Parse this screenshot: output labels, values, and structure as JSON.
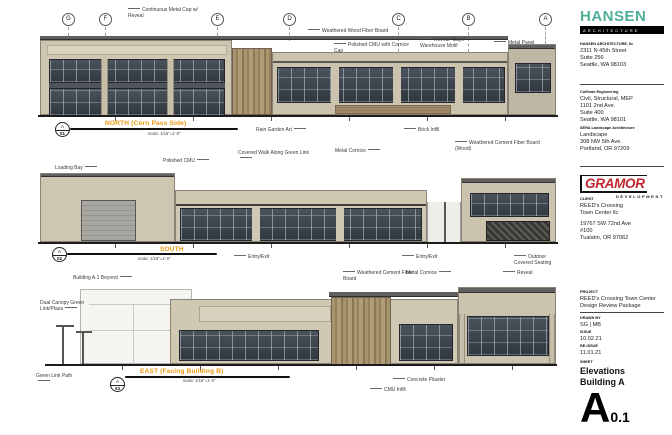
{
  "accents": {
    "elevation_title": "#e8950c",
    "architect_teal": "#4fb09a",
    "developer_red": "#c0272d"
  },
  "grid": {
    "labels": [
      "G",
      "F",
      "E",
      "D",
      "C",
      "B",
      "A"
    ]
  },
  "elevations": {
    "north": {
      "title": "NORTH (Corn Pass Side)",
      "scale": "scale: 1/16\"=1'-0\"",
      "marker": {
        "top": "A",
        "bottom": "01"
      },
      "callouts": {
        "metal_cap": "Continuous Metal Cap w/ Reveal",
        "wood_fiber": "Weathered Wood Fiber Board",
        "polished_cmu": "Polished CMU with Cornice Cap",
        "reveal_bays": "Reveal \"Bays\" Warehouse Motif",
        "metal_panel": "Metal Panel",
        "rain_garden": "Rain Garden Art",
        "brick_infill": "Brick Infill"
      }
    },
    "south": {
      "title": "SOUTH",
      "scale": "scale: 1/16\"=1'-0\"",
      "marker": {
        "top": "A",
        "bottom": "02"
      },
      "callouts": {
        "loading_bay": "Loading Bay",
        "polished_cmu": "Polished CMU",
        "covered_walk": "Covered Walk Along Green Link",
        "metal_cornice": "Metal Cornice",
        "cement_fiber": "Weathered Cement Fiber Board (Wood)",
        "entry_exit_1": "Entry/Exit",
        "entry_exit_2": "Entry/Exit",
        "outdoor_seating": "Outdoor Covered Seating"
      }
    },
    "east": {
      "title": "EAST (Facing Building B)",
      "scale": "scale: 1/16\"=1'-0\"",
      "marker": {
        "top": "A",
        "bottom": "03"
      },
      "callouts": {
        "building_beyond": "Building A.1 Beyond",
        "dual_canopy": "Dual Canopy Green Link/Plaza",
        "cement_fiber": "Weathered Cement Fiber Board",
        "metal_cornice": "Metal Cornice",
        "reveal": "Reveal",
        "green_link": "Green Link Path",
        "cmu_infill": "CMU Infill",
        "concrete_pilaster": "Concrete Pilaster"
      }
    }
  },
  "titleblock": {
    "architect": {
      "logo_text": "HANSEN",
      "logo_sub": "ARCHITECTURE",
      "firm_heading": "HANSEN ARCHITECTURE, llc",
      "firm_lines": [
        "2311 N 45th Street",
        "Suite 256",
        "Seattle, WA 98103"
      ]
    },
    "consultants": [
      {
        "heading": "Coffman Engineering",
        "lines": [
          "Civil, Structural, MEP",
          "1101 2nd Ave.",
          "Suite 400",
          "Seattle, WA 98101"
        ]
      },
      {
        "heading": "SERA Landscape Architecture",
        "lines": [
          "Landscape",
          "308 NW 5th Ave.",
          "Portland, OR 97209"
        ]
      }
    ],
    "developer": {
      "logo_text": "GRAMOR",
      "logo_sub": "DEVELOPMENT"
    },
    "client": {
      "label": "CLIENT",
      "name_lines": [
        "REED's Crossing",
        "Town Center llc"
      ],
      "address_lines": [
        "19767 SW 72nd Ave",
        "#100",
        "Tualatin, OR 97062"
      ]
    },
    "project": {
      "label": "PROJECT",
      "lines": [
        "REED's Crossing Town Center",
        "Design Review Package"
      ]
    },
    "drawn_by": {
      "label": "DRAWN BY",
      "value": "SG | MB"
    },
    "issue": {
      "label": "ISSUE",
      "value": "10.02.21"
    },
    "reissue": {
      "label": "RE-ISSUE",
      "value": "11.01.21"
    },
    "sheet": {
      "label": "SHEET",
      "title_lines": [
        "Elevations",
        "Building A"
      ],
      "number_big": "A",
      "number_small": "0.1"
    }
  }
}
